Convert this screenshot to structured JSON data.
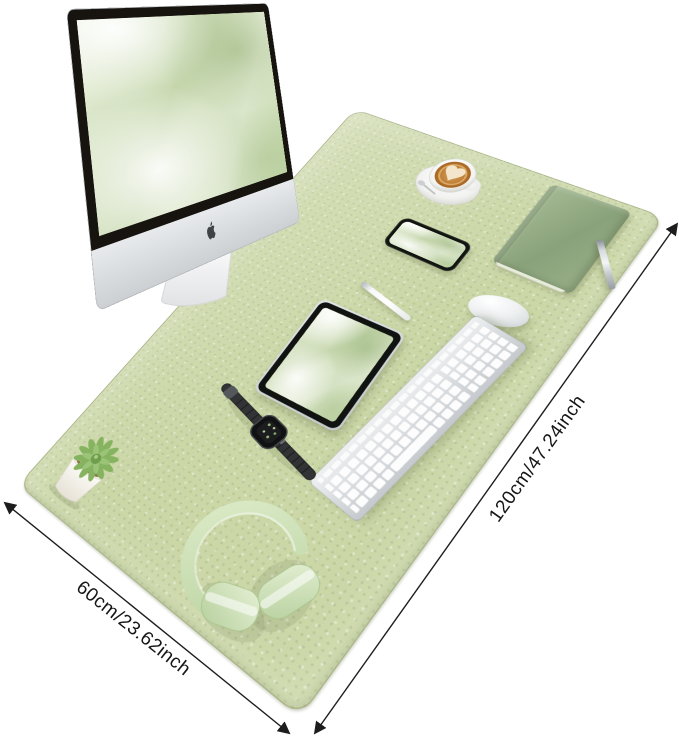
{
  "meta": {
    "type": "product-photo",
    "subject": "Green leather desk mat (desk pad) styled with office accessories on white background"
  },
  "dimension_labels": {
    "length": "120cm/47.24inch",
    "width": "60cm/23.62inch"
  },
  "colors": {
    "background": "#ffffff",
    "mat_green": "#cbd7a7",
    "notebook_green": "#93aa85",
    "headphones_green": "#cfe3bb",
    "wallpaper_green": "#dce8cc",
    "coffee_brown": "#b5722d",
    "annotation_black": "#1d1d1d"
  },
  "objects": [
    {
      "name": "imac-monitor",
      "description": "silver iMac with black bezel and green abstract wallpaper"
    },
    {
      "name": "coffee-cup",
      "description": "latte with heart art on white saucer with spoon"
    },
    {
      "name": "smartphone",
      "description": "phone lying flat with green wallpaper"
    },
    {
      "name": "notebook",
      "description": "green hardcover notebook"
    },
    {
      "name": "pen",
      "description": "silver ballpoint pen"
    },
    {
      "name": "mouse",
      "description": "white wireless mouse"
    },
    {
      "name": "stylus-pencil",
      "description": "white stylus pencil"
    },
    {
      "name": "tablet",
      "description": "tablet with green wallpaper"
    },
    {
      "name": "keyboard",
      "description": "silver-white wireless keyboard with number pad"
    },
    {
      "name": "smartwatch",
      "description": "smartwatch with dark link band"
    },
    {
      "name": "headphones",
      "description": "pale green over-ear headphones"
    },
    {
      "name": "succulent-plant",
      "description": "green succulent in white square pot"
    }
  ]
}
